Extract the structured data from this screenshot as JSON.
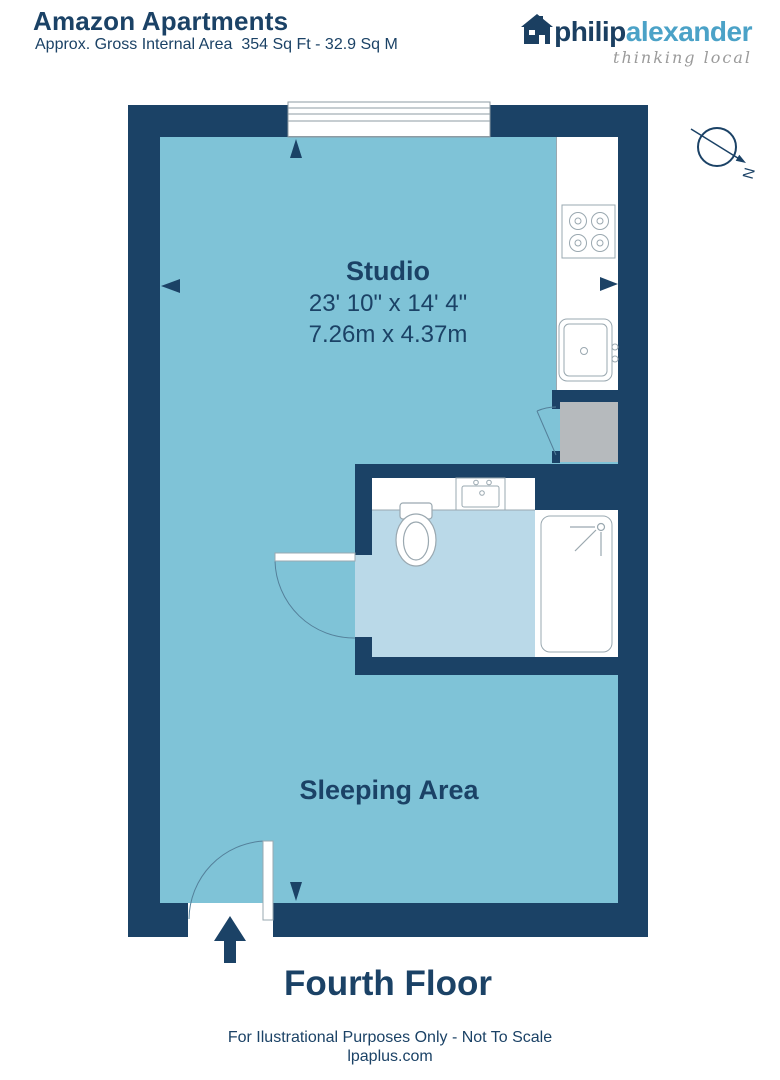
{
  "header": {
    "title": "Amazon Apartments",
    "subtitle": "Approx. Gross Internal Area  354 Sq Ft - 32.9 Sq M"
  },
  "logo": {
    "brand_primary": "philip",
    "brand_secondary": "alexander",
    "tagline": "thinking local"
  },
  "compass": {
    "label": "N"
  },
  "floorplan": {
    "rooms": [
      {
        "name": "Studio",
        "dims_imperial": "23' 10\" x 14' 4\"",
        "dims_metric": "7.26m x 4.37m"
      },
      {
        "name": "Sleeping Area"
      }
    ],
    "fixtures": [
      "window",
      "hob",
      "kitchen-sink",
      "storage-cupboard",
      "wash-basin",
      "toilet",
      "shower",
      "entrance-door",
      "bathroom-door",
      "cupboard-door"
    ]
  },
  "footer": {
    "floor_label": "Fourth Floor",
    "disclaimer": "For Ilustrational Purposes Only - Not To Scale",
    "website": "lpaplus.com"
  },
  "colors": {
    "wall_navy": "#1b4266",
    "studio_floor": "#7fc3d7",
    "bathroom_floor": "#bad9e8",
    "cupboard_gray": "#b6babd",
    "logo_blue": "#4ba2c7",
    "fixture_outline": "#9aa8b0"
  }
}
